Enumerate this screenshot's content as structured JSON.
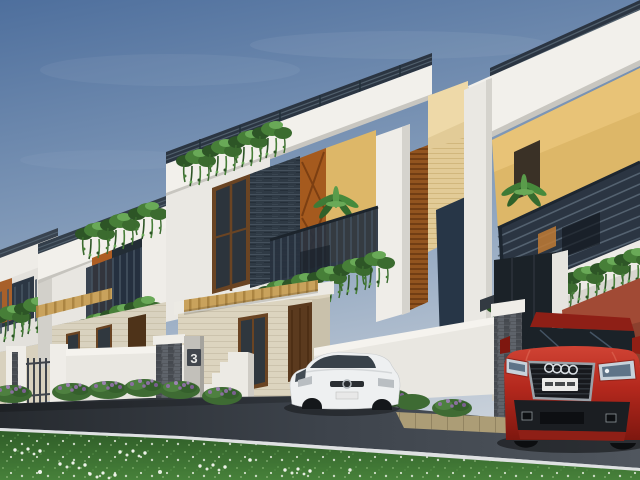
{
  "meta": {
    "title": "Row of modern duplex villas - 3D exterior architectural render",
    "description": "Street-side view of a receding row of white box-style two-storey villas with dark roof railings, balconies with hanging plants, slate / yellow / timber accent walls, compound walls with stone pillars, a white hatchback parked at house 3 and a red SUV in the right driveway, asphalt road and flowering lawn in the foreground."
  },
  "scene": {
    "house_number": "3",
    "labels": {
      "house_number_plaque": "3"
    },
    "vehicles": {
      "suv": {
        "type": "red-suv",
        "badge": "audi-four-rings-icon",
        "license_plate_legible": false
      },
      "hatchback": {
        "type": "white-hatchback",
        "badge": "grille-badge-icon"
      }
    },
    "palette": {
      "sky_top": "#4e6f9d",
      "sky_mid": "#8aa1bd",
      "sky_horizon": "#c9d1da",
      "white_wall": "#f2f0eb",
      "white_wall_shade": "#d6d4ce",
      "cream_wall": "#dcd4bf",
      "yellow_wall": "#ddb768",
      "terracotta_wall": "#a14a35",
      "slate_stone": "#2f3a45",
      "railing_dark": "#2b3542",
      "wood_door": "#a55a1e",
      "wood_dark": "#5b3a1e",
      "pergola_wood": "#c9a25c",
      "louver_brown": "#92541f",
      "tower_tan": "#e2cb97",
      "plant_green": "#477f38",
      "plant_green_dark": "#2d5526",
      "plant_green_light": "#69a957",
      "flower_purple": "#8a6fa0",
      "lawn_dark": "#2f5d28",
      "lawn_light": "#47813a",
      "road_dark": "#262a2f",
      "road_mid": "#3d434b",
      "road_light": "#50565e",
      "curb_white": "#dfe1e2",
      "paver_tan": "#ac9d76",
      "suv_red_hi": "#d04334",
      "suv_red": "#b3281d",
      "suv_red_dark": "#7e170f",
      "car_white": "#eef0f1",
      "plate_white": "#ebebe9",
      "glass_dark": "#1b2228"
    }
  }
}
